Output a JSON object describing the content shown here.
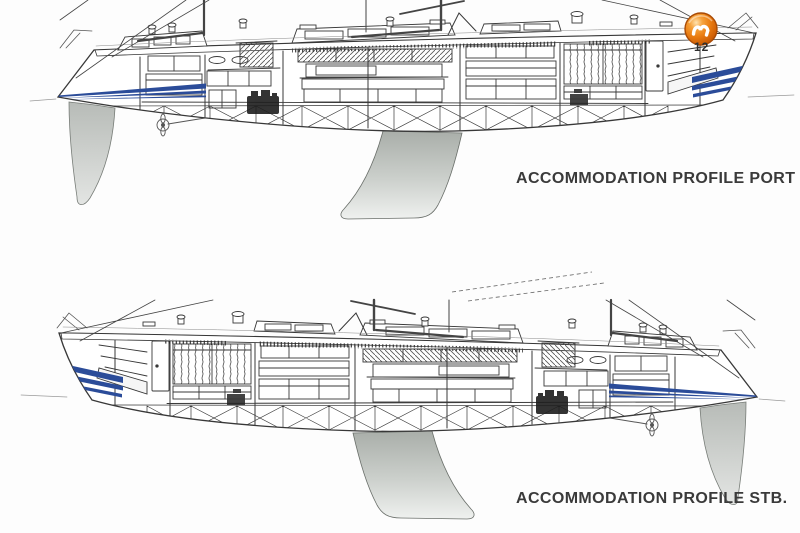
{
  "captions": {
    "port": "ACCOMMODATION PROFILE PORT",
    "starboard": "ACCOMMODATION PROFILE STB."
  },
  "annotations": {
    "bow_station_number": "12"
  },
  "branding": {
    "logo_icon": "orange-glossy-sphere-swoosh-logo"
  },
  "colors": {
    "paper": "#fdfdfd",
    "ink": "#383838",
    "hull_stripe_blue": "#2b4c99",
    "keel_gray": "#c3c7c3",
    "logo_orange": "#ea7d12"
  }
}
